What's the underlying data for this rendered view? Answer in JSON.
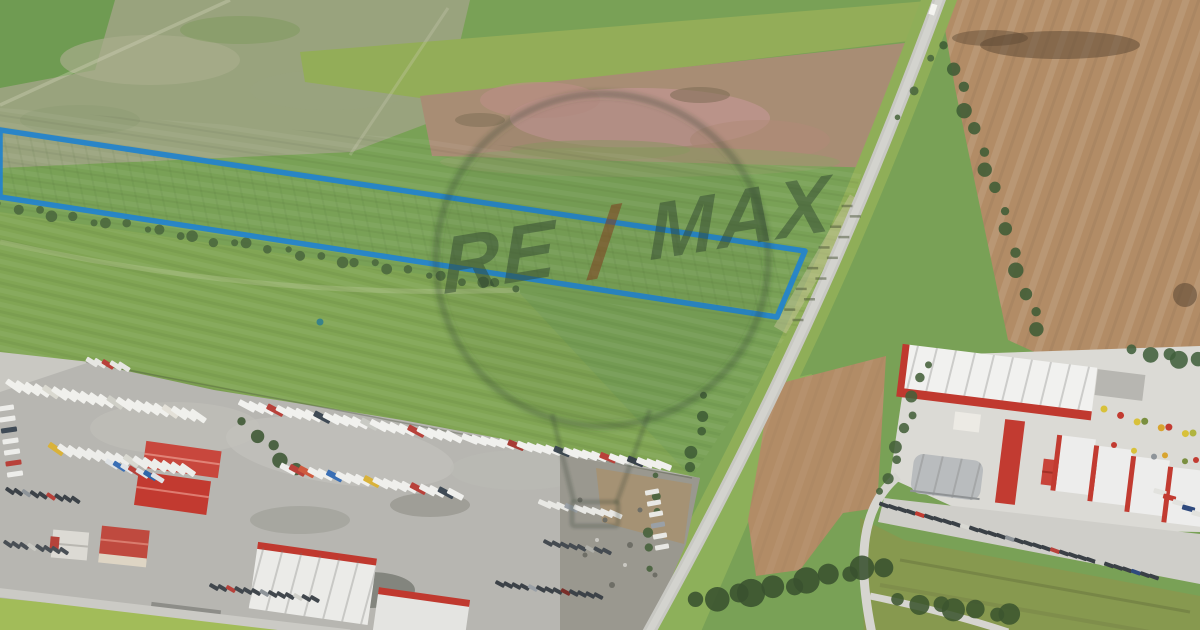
{
  "meta": {
    "width": 1200,
    "height": 630,
    "kind": "aerial-photo-listing"
  },
  "watermark": {
    "brand": "RE/MAX",
    "left": "RE",
    "slash": "/",
    "right": "MAX",
    "text_color": "#2f4530",
    "slash_color": "#7e4423",
    "balloon_color": "#2e4030"
  },
  "parcel": {
    "points": "0,130 805,251 777,317 0,197",
    "stroke": "#2484cb",
    "stroke_width": 5.5
  },
  "marker": {
    "cx": 320,
    "cy": 322,
    "r": 3.5,
    "color": "#2d7d8f"
  },
  "palette": {
    "base": "#79a156",
    "fallow": "#99a37d",
    "corner_green": "#6f9b52",
    "strip_green": "#93ad58",
    "pink_field": "#a88d74",
    "plowed": "#b28c66",
    "road": "#c8c8c3",
    "road_inner": "#d3d3ce",
    "verge": "#8fae58",
    "asphalt": "#b7b6b1",
    "concrete": "#dbdad5",
    "red_roof": "#c0392f",
    "white_roof": "#f1f1ef",
    "grass_low": "#87994f",
    "bright_field": "#a2bc59"
  },
  "scene": {
    "vehicle_rows": [
      {
        "name": "trailer",
        "x": 14,
        "y": 386,
        "dx": 9.2,
        "dy": 1.5,
        "n": 21,
        "w": 6,
        "h": 18,
        "rot": -55,
        "base": "#f0f0ec",
        "colors": {
          "4": "#dad9d0",
          "11": "#cfcfc7",
          "17": "#e4e1d8"
        }
      },
      {
        "name": "trailer",
        "x": 247,
        "y": 406,
        "dx": 9.4,
        "dy": 1.4,
        "n": 23,
        "w": 6,
        "h": 18,
        "rot": -62,
        "base": "#f1f1ee",
        "colors": {
          "3": "#b8413a",
          "8": "#3f4a55",
          "13": "#c9cac4",
          "18": "#b8413a"
        }
      },
      {
        "name": "trailer",
        "x": 470,
        "y": 439,
        "dx": 9.2,
        "dy": 1.25,
        "n": 22,
        "w": 6,
        "h": 17,
        "rot": -68,
        "base": "#f0f0ed",
        "colors": {
          "5": "#a63c35",
          "10": "#3f4a55",
          "15": "#b8413a",
          "18": "#39424d"
        }
      },
      {
        "name": "trailer",
        "x": 56,
        "y": 449,
        "dx": 9.4,
        "dy": 1.5,
        "n": 15,
        "w": 6,
        "h": 17,
        "rot": -55,
        "base": "#ededea",
        "colors": {
          "0": "#d9b23a",
          "8": "#d8d8d0"
        }
      },
      {
        "name": "trailer",
        "x": 288,
        "y": 469,
        "dx": 9.3,
        "dy": 1.4,
        "n": 19,
        "w": 6,
        "h": 17,
        "rot": -62,
        "base": "#efefec",
        "colors": {
          "1": "#b8413a",
          "2": "#cf5a3f",
          "5": "#3a6fb5",
          "9": "#d9b23a",
          "14": "#b8413a",
          "17": "#3f4a55"
        }
      },
      {
        "name": "container",
        "x": 112,
        "y": 464,
        "dx": 7.6,
        "dy": 2.3,
        "n": 7,
        "w": 5,
        "h": 14,
        "rot": -58,
        "base": "#dfe3e6",
        "colors": {
          "1": "#3a6fb5",
          "3": "#b8413a",
          "5": "#2e66a8"
        }
      },
      {
        "name": "trailer",
        "x": 545,
        "y": 504,
        "dx": 8.8,
        "dy": 1.3,
        "n": 9,
        "w": 5,
        "h": 14,
        "rot": -66,
        "base": "#e8e8e4",
        "colors": {
          "3": "#9aa0a6"
        }
      },
      {
        "name": "truck-side",
        "x": 6,
        "y": 408,
        "dx": 1.5,
        "dy": 11,
        "n": 7,
        "w": 16,
        "h": 5,
        "rot": -8,
        "base": "#ededea",
        "colors": {
          "2": "#3f4a55",
          "5": "#b8413a"
        }
      },
      {
        "name": "truck-side",
        "x": 652,
        "y": 492,
        "dx": 2.0,
        "dy": 11,
        "n": 6,
        "w": 14,
        "h": 5,
        "rot": -10,
        "base": "#e8e8e4",
        "colors": {
          "3": "#9aa0a6"
        }
      },
      {
        "name": "box-truck",
        "x": 92,
        "y": 362,
        "dx": 8.0,
        "dy": 1.2,
        "n": 5,
        "w": 5,
        "h": 13,
        "rot": -58,
        "base": "#e6e6e2",
        "colors": {
          "2": "#b8413a"
        }
      },
      {
        "name": "car",
        "x": 10,
        "y": 491,
        "dx": 8.2,
        "dy": 1.1,
        "n": 9,
        "w": 4,
        "h": 10,
        "rot": -55,
        "base": "#3c4248",
        "colors": {
          "2": "#8e9499",
          "5": "#b8413a"
        }
      },
      {
        "name": "car",
        "x": 8,
        "y": 544,
        "dx": 8.0,
        "dy": 1.0,
        "n": 8,
        "w": 4,
        "h": 10,
        "rot": -55,
        "base": "#494f55",
        "colors": {
          "3": "#c8c8c2"
        }
      },
      {
        "name": "car",
        "x": 214,
        "y": 587,
        "dx": 8.4,
        "dy": 1.0,
        "n": 13,
        "w": 4,
        "h": 10,
        "rot": -60,
        "base": "#41474d",
        "colors": {
          "2": "#b8413a",
          "6": "#8e9499",
          "10": "#d0d0ca"
        }
      },
      {
        "name": "car",
        "x": 500,
        "y": 584,
        "dx": 8.2,
        "dy": 1.0,
        "n": 13,
        "w": 4,
        "h": 10,
        "rot": -62,
        "base": "#3c4248",
        "colors": {
          "4": "#9aa0a6",
          "8": "#7a2f2a"
        }
      },
      {
        "name": "car",
        "x": 548,
        "y": 543,
        "dx": 8.4,
        "dy": 1.2,
        "n": 8,
        "w": 4,
        "h": 10,
        "rot": -62,
        "base": "#454b51",
        "colors": {
          "5": "#b0b0aa"
        }
      },
      {
        "name": "car",
        "x": 884,
        "y": 505,
        "dx": 9.0,
        "dy": 2.4,
        "n": 31,
        "w": 4,
        "h": 10,
        "rot": -70,
        "base": "#3a4046",
        "colors": {
          "4": "#c23b31",
          "9": "#d8d8d2",
          "14": "#8e9499",
          "19": "#b8413a",
          "24": "#d0d0ca",
          "28": "#2f4a7e"
        }
      },
      {
        "name": "truck",
        "x": 1160,
        "y": 492,
        "dx": 9.5,
        "dy": 5.5,
        "n": 5,
        "w": 5,
        "h": 13,
        "rot": -75,
        "base": "#e2e2de",
        "colors": {
          "1": "#c23b31",
          "3": "#2f4a7e"
        }
      }
    ],
    "hedges": [
      {
        "x1": 948,
        "y1": 48,
        "x2": 1040,
        "y2": 332,
        "n": 15,
        "r": 6,
        "color": "#3f5c35"
      },
      {
        "x1": 884,
        "y1": 494,
        "x2": 924,
        "y2": 364,
        "n": 9,
        "r": 5,
        "color": "#44603a"
      },
      {
        "x1": 2,
        "y1": 206,
        "x2": 515,
        "y2": 288,
        "n": 30,
        "r": 4.5,
        "color": "#4a673d"
      },
      {
        "x1": 700,
        "y1": 602,
        "x2": 882,
        "y2": 566,
        "n": 11,
        "r": 11,
        "color": "#39512f"
      },
      {
        "x1": 902,
        "y1": 602,
        "x2": 1012,
        "y2": 614,
        "n": 7,
        "r": 9,
        "color": "#3c552f"
      },
      {
        "x1": 1136,
        "y1": 352,
        "x2": 1198,
        "y2": 360,
        "n": 5,
        "r": 7,
        "color": "#41603c"
      },
      {
        "x1": 708,
        "y1": 398,
        "x2": 690,
        "y2": 468,
        "n": 5,
        "r": 5,
        "color": "#3f5c35"
      },
      {
        "x1": 660,
        "y1": 478,
        "x2": 646,
        "y2": 566,
        "n": 6,
        "r": 4,
        "color": "#44603a"
      },
      {
        "x1": 902,
        "y1": 120,
        "x2": 928,
        "y2": 60,
        "n": 3,
        "r": 4,
        "color": "#4a673d"
      },
      {
        "x1": 246,
        "y1": 424,
        "x2": 296,
        "y2": 470,
        "n": 5,
        "r": 6,
        "color": "#3c5632"
      }
    ],
    "ticks": {
      "x1": 853,
      "y1": 206,
      "x2": 790,
      "y2": 320,
      "n": 12,
      "w": 11,
      "h": 2.5,
      "color": "rgba(72,82,52,0.5)"
    },
    "dotrows": [
      {
        "x1": 1108,
        "y1": 412,
        "x2": 1196,
        "y2": 436,
        "n": 8,
        "r": 3.5,
        "colors": [
          "#d8c13a",
          "#c23b31",
          "#d8c13a",
          "#7a8f3f",
          "#d8a42f",
          "#c23b31",
          "#d8c13a",
          "#b0b43f"
        ]
      },
      {
        "x1": 1118,
        "y1": 448,
        "x2": 1198,
        "y2": 462,
        "n": 6,
        "r": 3,
        "colors": [
          "#c23b31",
          "#d8c13a",
          "#8e9499",
          "#d8a42f",
          "#7a8f3f",
          "#c23b31"
        ]
      }
    ]
  }
}
